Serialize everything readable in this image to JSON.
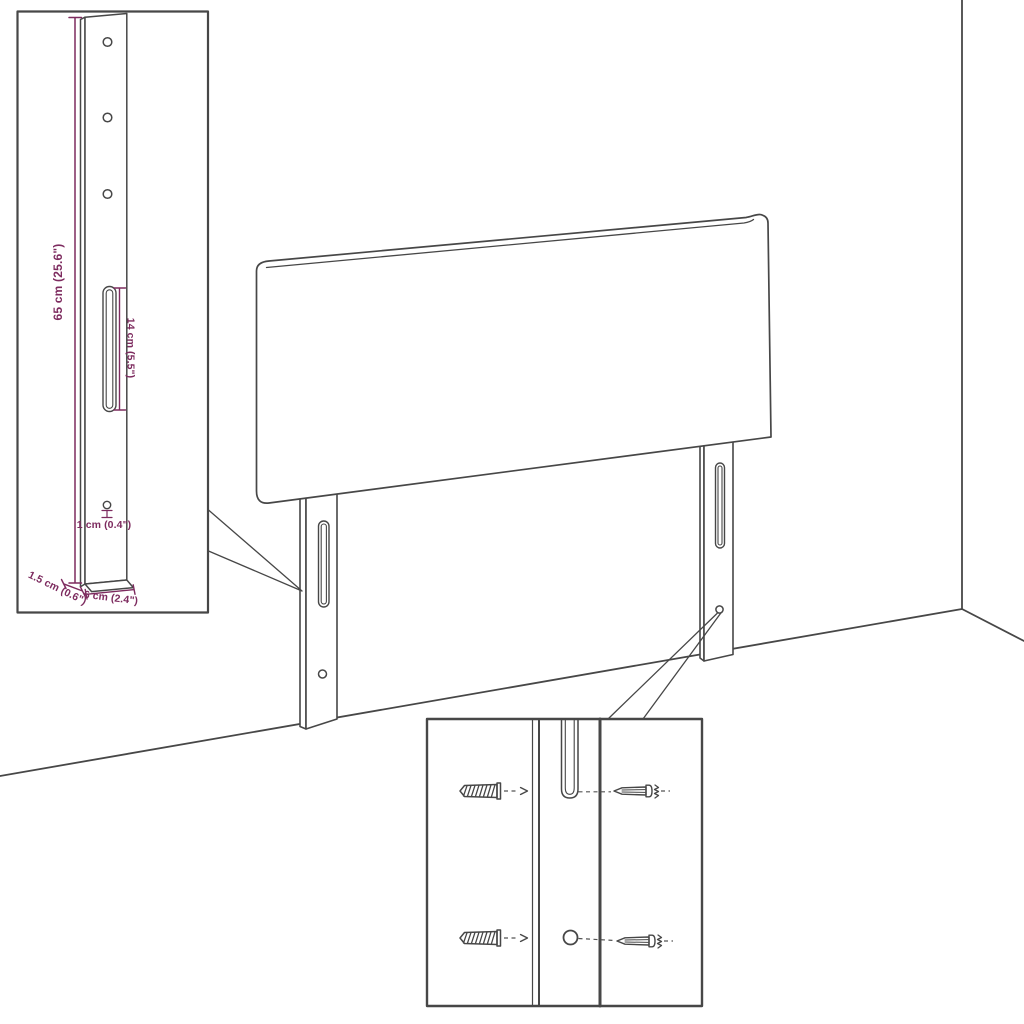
{
  "colors": {
    "background": "#ffffff",
    "line_art": "#474747",
    "dimension_annotation": "#7D2B5F"
  },
  "bracket_detail_inset": {
    "labels": {
      "bracket_height": "65 cm (25.6\")",
      "slot_length": "14 cm (5.5\")",
      "hole_diameter": "1 cm (0.4\")",
      "bracket_depth": "1.5 cm (0.6\")",
      "bracket_width": "6 cm (2.4\")"
    }
  },
  "hardware_detail_inset": {
    "icons": [
      "wall-plug-icon",
      "screw-icon"
    ]
  }
}
